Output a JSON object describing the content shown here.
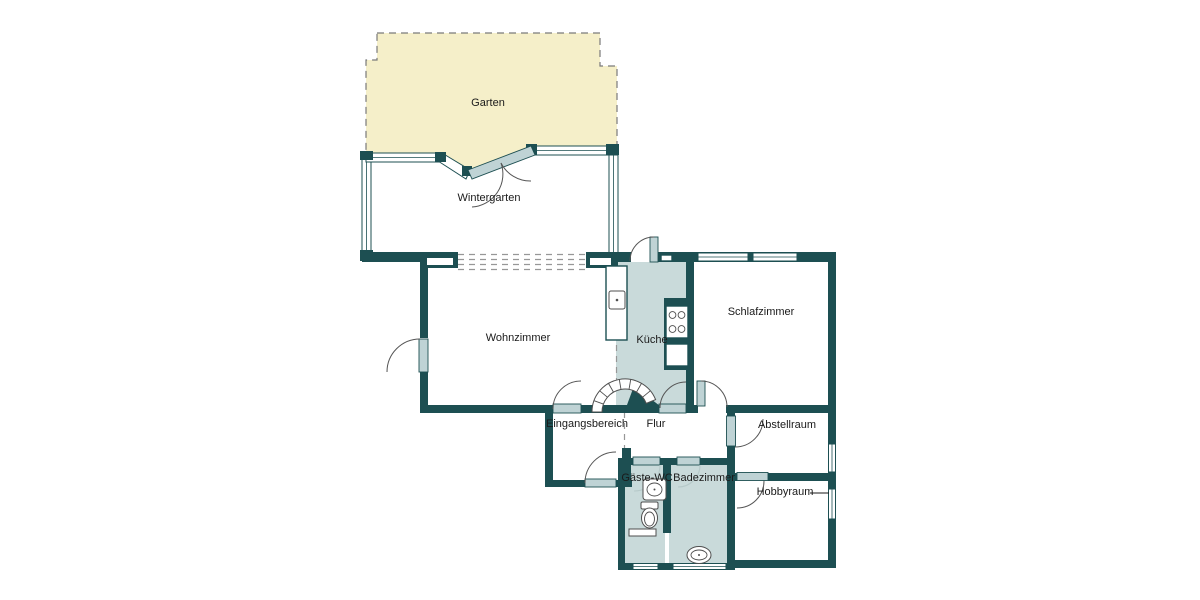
{
  "floorplan": {
    "rooms": {
      "garten": {
        "label": "Garten"
      },
      "wintergarten": {
        "label": "Wintergarten"
      },
      "wohnzimmer": {
        "label": "Wohnzimmer"
      },
      "kueche": {
        "label": "Küche"
      },
      "schlafzimmer": {
        "label": "Schlafzimmer"
      },
      "eingangsbereich": {
        "label": "Eingangsbereich"
      },
      "flur": {
        "label": "Flur"
      },
      "abstellraum": {
        "label": "Abstellraum"
      },
      "gaeste_wc": {
        "label": "Gäste-WC"
      },
      "badezimmer": {
        "label": "Badezimmer"
      },
      "hobbyraum": {
        "label": "Hobbyraum"
      }
    },
    "colors": {
      "wall": "#1d4f52",
      "room_fill": "#c9dada",
      "door_leaf": "#bfd3d5",
      "garden_fill": "#f5efc9",
      "dash_gray": "#979797",
      "outline_gray": "#555555",
      "label_text": "#1a1a1a",
      "background": "#ffffff"
    }
  }
}
